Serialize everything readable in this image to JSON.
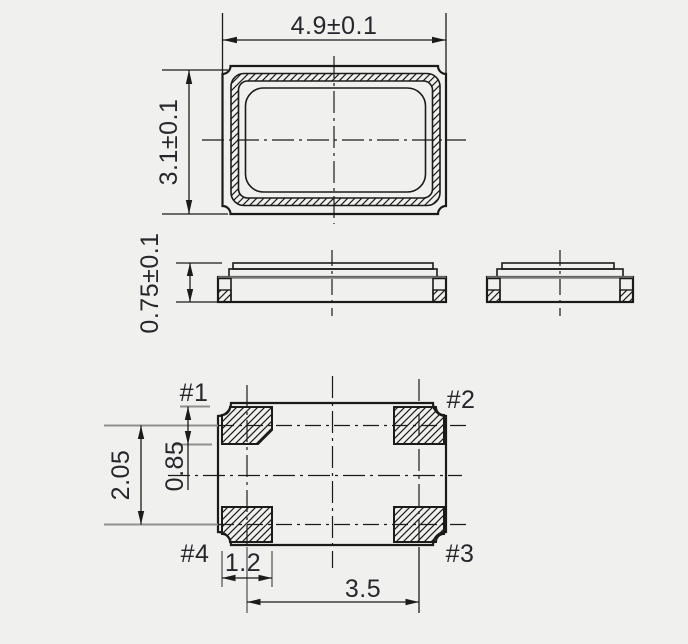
{
  "figure": {
    "background": "#f0f0ee",
    "line_color": "#1b1b1b",
    "gray_line_color": "#8f8f8f",
    "text_color": "#26262c"
  },
  "top_view": {
    "width_dim": "4.9±0.1",
    "height_dim": "3.1±0.1"
  },
  "front_view": {
    "height_dim": "0.75±0.1"
  },
  "bottom_view": {
    "pads": {
      "p1": "#1",
      "p2": "#2",
      "p3": "#3",
      "p4": "#4"
    },
    "row_pitch": "2.05",
    "pad_height": "0.85",
    "pad_width": "1.2",
    "col_pitch": "3.5"
  }
}
